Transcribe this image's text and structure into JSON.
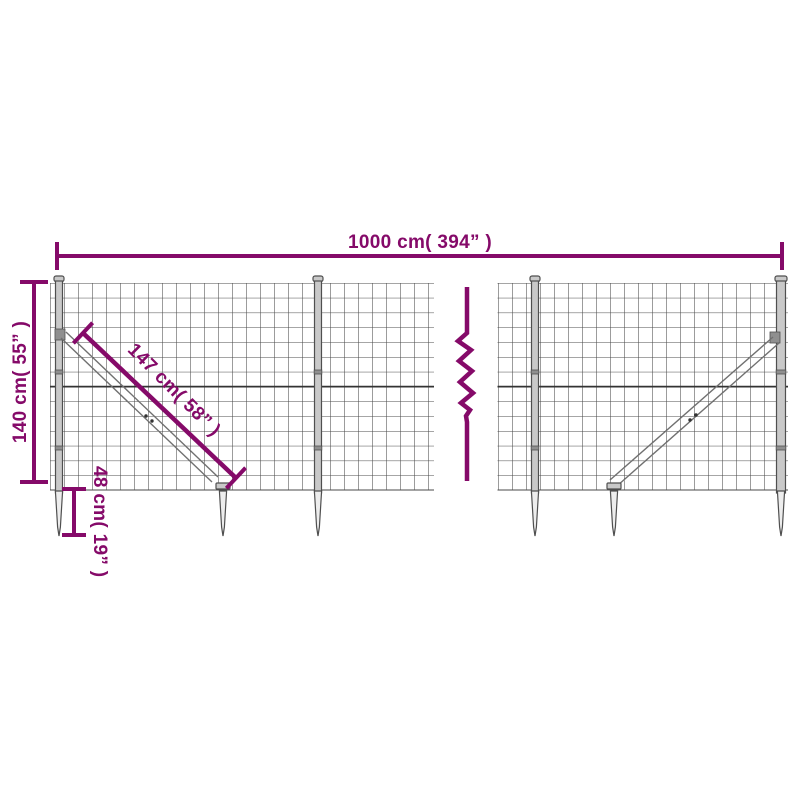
{
  "colors": {
    "accent": "#850A69",
    "mesh": "#4A4A4A",
    "mesh-dark": "#333333",
    "steel-fill": "#C9C9C9",
    "steel-light": "#EDEDED",
    "steel-stroke": "#4F4F4F",
    "brace": "#707070",
    "background": "#FFFFFF"
  },
  "diagram": {
    "type": "product dimension diagram",
    "subject": "wire mesh fence with diagonal braces and ground anchor spikes",
    "labels": {
      "total_width": "1000 cm( 394” )",
      "height": "140 cm( 55” )",
      "brace_length": "147 cm( 58” )",
      "spike_length": "48 cm( 19” )"
    }
  }
}
